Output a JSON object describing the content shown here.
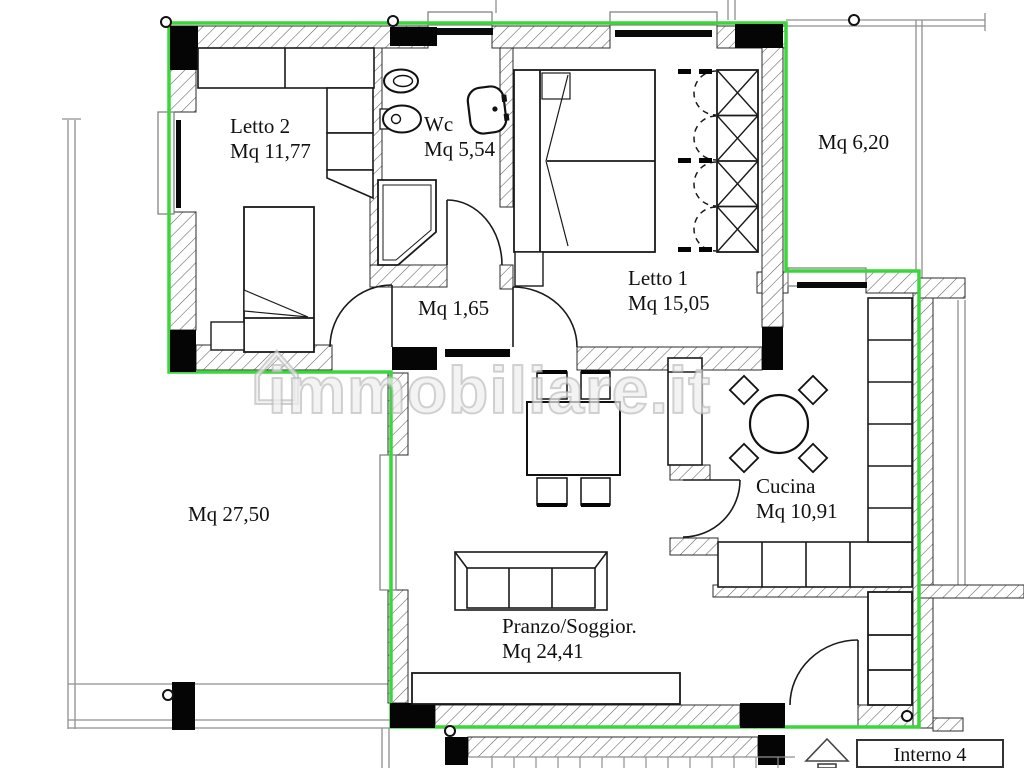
{
  "plan": {
    "watermark": "immobiliare.it",
    "watermark_icon": "⌂",
    "unit_box": {
      "label": "Interno 4"
    },
    "rooms": {
      "letto2": {
        "name": "Letto 2",
        "area": "Mq 11,77"
      },
      "wc": {
        "name": "Wc",
        "area": "Mq 5,54"
      },
      "letto1": {
        "name": "Letto 1",
        "area": "Mq 15,05"
      },
      "balcony_right": {
        "name": "",
        "area": "Mq 6,20"
      },
      "hallway": {
        "name": "",
        "area": "Mq 1,65"
      },
      "terrace_left": {
        "name": "",
        "area": "Mq 27,50"
      },
      "cucina": {
        "name": "Cucina",
        "area": "Mq 10,91"
      },
      "living": {
        "name": "Pranzo/Soggior.",
        "area": "Mq 24,41"
      }
    },
    "colors": {
      "boundary_green": "#3bd63b",
      "pillar_black": "#050505",
      "hatch_gray": "#606060",
      "thin_gray": "#8f8f8f",
      "paper": "#ffffff"
    }
  }
}
